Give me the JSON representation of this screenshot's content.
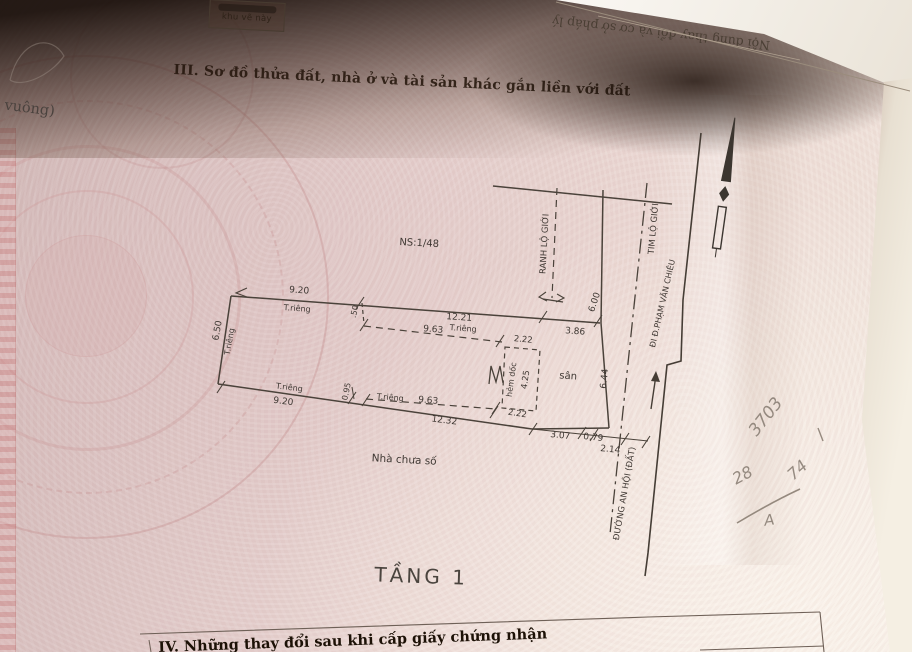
{
  "photo": {
    "back_page_text": "Nội dung thay đổi và cơ sở pháp lý",
    "corner_box_label": "khu vẽ này",
    "left_edge_fragment": "t vuông)"
  },
  "document": {
    "section_heading": "III. Sơ đồ thửa đất, nhà ở và tài sản khác gắn liền với đất",
    "floor_caption": "TẦNG 1",
    "next_section_heading": "IV. Những thay đổi sau khi cấp giấy chứng nhận"
  },
  "diagram": {
    "neighbor_house_label": "NS:1/48",
    "house_label": "Nhà chưa số",
    "yard_label": "sân",
    "alley_label": "hẻm dốc",
    "road_boundary_label": "RANH LỘ GIỚI",
    "road_centerline_label": "TIM LỘ GIỚI",
    "road_name_label": "ĐƯỜNG AN HỘI (ĐẤT)",
    "road_direction_label": "ĐI Đ.PHẠM VĂN CHIÊU",
    "private_use_label": "T.riêng",
    "dimensions": {
      "top_seg1": "9.20",
      "top_seg2": "12.21",
      "top_seg3": "3.86",
      "left_side": "6.50",
      "setback": ".50",
      "inner_top": "9.63",
      "alley_width_top": "2.22",
      "alley_length": "4.25",
      "alley_width_bottom": "2.22",
      "bottom_seg1": "9.20",
      "bottom_jog": "0.95",
      "inner_bottom": "9.63",
      "bottom_total": "12.32",
      "yard_bottom1": "3.07",
      "yard_bottom2": "0.79",
      "to_road_edge": "2.14",
      "yard_right": "6.44",
      "road_half_width": "6.00"
    }
  },
  "annotations": {
    "mark1": "3703",
    "mark2": "28",
    "mark3": "74",
    "mark4": "A"
  },
  "colors": {
    "paper_pink": "#e5d0cd",
    "ink": "#3f3833",
    "pencil": "#8b8076",
    "shadow": "#241711",
    "page_edge_white": "#f5efe3"
  }
}
